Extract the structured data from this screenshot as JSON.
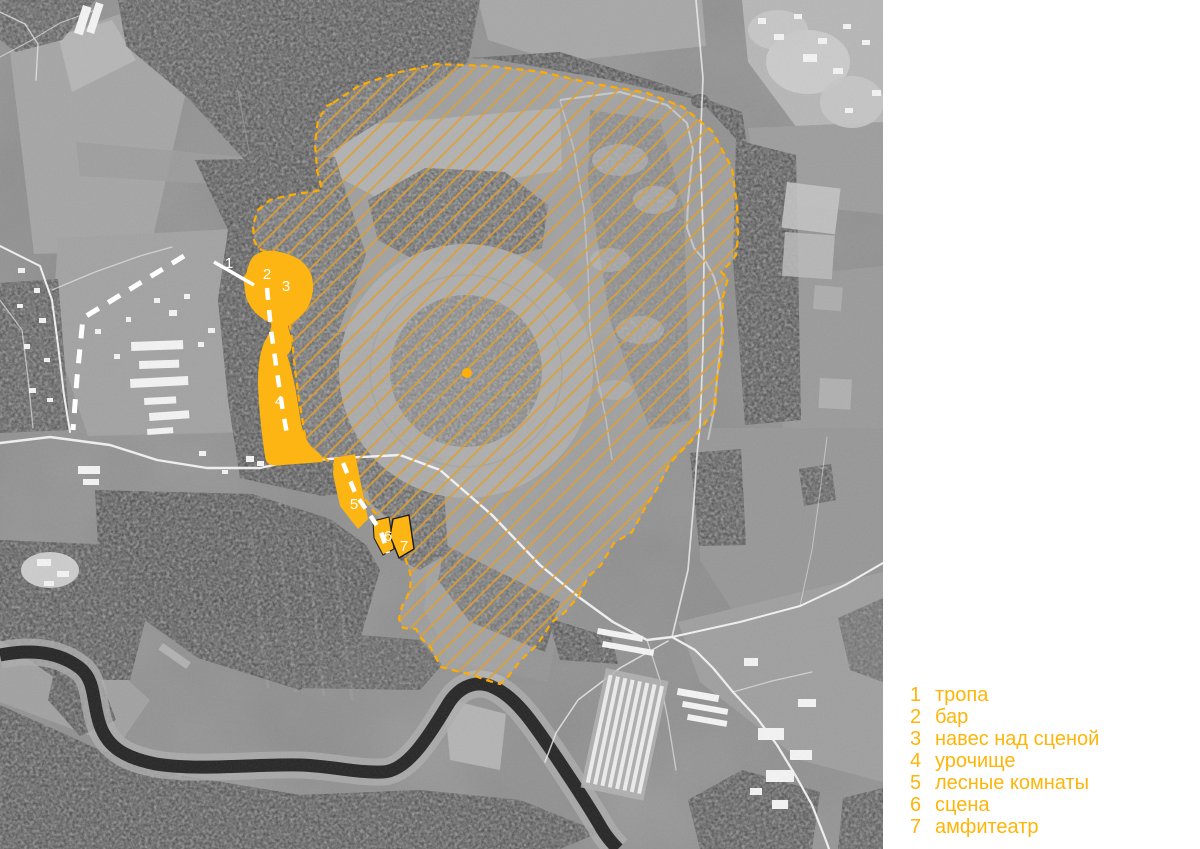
{
  "legend": {
    "color": "#ffb508",
    "items": [
      {
        "num": "1",
        "label": "тропа"
      },
      {
        "num": "2",
        "label": "бар"
      },
      {
        "num": "3",
        "label": "навес над сценой"
      },
      {
        "num": "4",
        "label": "урочище"
      },
      {
        "num": "5",
        "label": "лесные комнаты"
      },
      {
        "num": "6",
        "label": "сцена"
      },
      {
        "num": "7",
        "label": "амфитеатр"
      }
    ]
  },
  "map": {
    "labels": [
      {
        "num": "1"
      },
      {
        "num": "2"
      },
      {
        "num": "3"
      },
      {
        "num": "4"
      },
      {
        "num": "5"
      },
      {
        "num": "6"
      },
      {
        "num": "7"
      }
    ],
    "colors": {
      "site_fill": "#fcb513",
      "hatch_line": "#dfa030",
      "boundary": "#ffac00",
      "marker_text": "#ffffff"
    }
  }
}
